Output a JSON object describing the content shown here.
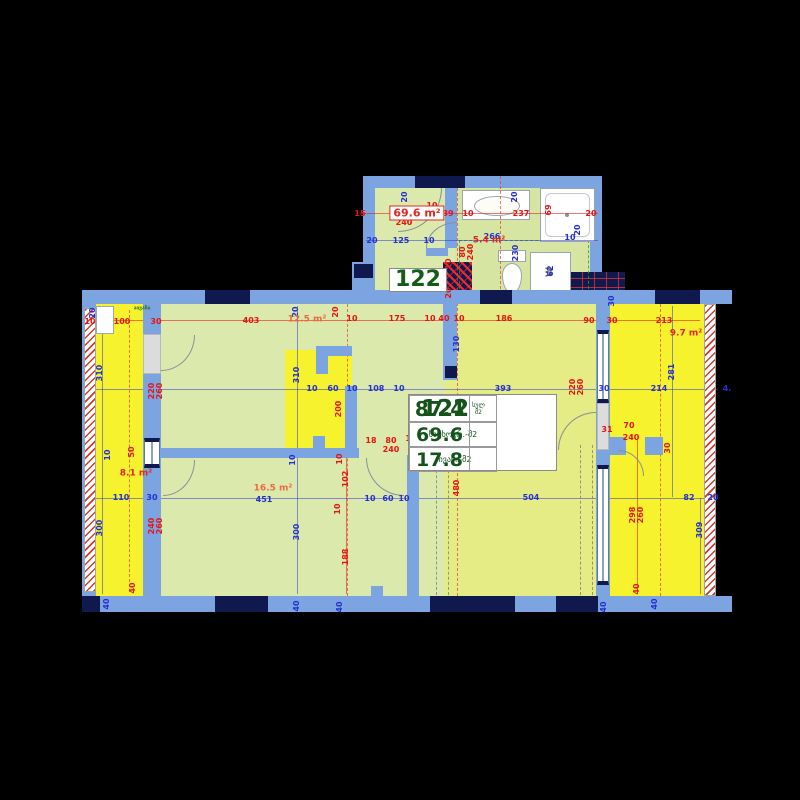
{
  "colors": {
    "background": "#000000",
    "wall_blue": "#7ba4e0",
    "column_navy": "#10194e",
    "room_green": "#dce9ad",
    "living_olive": "#e5eb85",
    "balcony_yellow": "#f6f22e",
    "bath_green": "#d6e5a2",
    "dim_red": "#e81313",
    "dim_blue": "#2430cf",
    "area_red": "#e3261d",
    "area_orange": "#ef6a3c",
    "label_green": "#155c15"
  },
  "info_card": {
    "unit_number": "122",
    "total_label_top": "სულ",
    "total_label_bottom": "მ2",
    "total_value": "87.4",
    "living_label": "საცხოვრ.-მ2",
    "living_value": "69.6",
    "balcony_label": "აივანი-მ2",
    "balcony_value": "17.8"
  },
  "fixtures": {
    "washer_label": "W"
  },
  "area_labels": [
    {
      "t": "69.6 m²",
      "x": 417,
      "y": 213,
      "s": "box-red"
    },
    {
      "t": "122",
      "x": 418,
      "y": 280,
      "s": "box-green"
    },
    {
      "t": "5.4 m²",
      "x": 489,
      "y": 241,
      "s": "red"
    },
    {
      "t": "12.5 m²",
      "x": 307,
      "y": 320,
      "s": "orange"
    },
    {
      "t": "8.1 m²",
      "x": 136,
      "y": 474,
      "s": "red"
    },
    {
      "t": "16.5 m²",
      "x": 273,
      "y": 489,
      "s": "orange"
    },
    {
      "t": "9.7 m²",
      "x": 686,
      "y": 334,
      "s": "red"
    },
    {
      "t": "აივანი",
      "x": 142,
      "y": 309,
      "s": "tiny-green"
    }
  ],
  "dims": [
    {
      "t": "15",
      "x": 360,
      "y": 214,
      "c": "r"
    },
    {
      "t": "95",
      "x": 396,
      "y": 214,
      "c": "r"
    },
    {
      "t": "15",
      "x": 417,
      "y": 214,
      "c": "r"
    },
    {
      "t": "10",
      "x": 432,
      "y": 206,
      "c": "r"
    },
    {
      "t": "39",
      "x": 448,
      "y": 214,
      "c": "r"
    },
    {
      "t": "240",
      "x": 404,
      "y": 223,
      "c": "r"
    },
    {
      "t": "10",
      "x": 468,
      "y": 214,
      "c": "r"
    },
    {
      "t": "237",
      "x": 521,
      "y": 214,
      "c": "r"
    },
    {
      "t": "20",
      "x": 591,
      "y": 214,
      "c": "r"
    },
    {
      "t": "69",
      "x": 549,
      "y": 210,
      "c": "r",
      "v": 1
    },
    {
      "t": "20",
      "x": 405,
      "y": 197,
      "c": "b",
      "v": 1
    },
    {
      "t": "20",
      "x": 515,
      "y": 197,
      "c": "b",
      "v": 1
    },
    {
      "t": "20",
      "x": 372,
      "y": 241,
      "c": "b"
    },
    {
      "t": "125",
      "x": 401,
      "y": 241,
      "c": "b"
    },
    {
      "t": "10",
      "x": 429,
      "y": 241,
      "c": "b"
    },
    {
      "t": "266",
      "x": 492,
      "y": 237,
      "c": "b"
    },
    {
      "t": "10",
      "x": 570,
      "y": 238,
      "c": "b"
    },
    {
      "t": "20",
      "x": 578,
      "y": 230,
      "c": "b",
      "v": 1
    },
    {
      "t": "230",
      "x": 516,
      "y": 253,
      "c": "b",
      "v": 1
    },
    {
      "t": "80",
      "x": 463,
      "y": 252,
      "c": "r",
      "v": 1
    },
    {
      "t": "240",
      "x": 471,
      "y": 252,
      "c": "r",
      "v": 1
    },
    {
      "t": "10",
      "x": 449,
      "y": 264,
      "c": "r",
      "v": 1
    },
    {
      "t": "20",
      "x": 449,
      "y": 293,
      "c": "r",
      "v": 1
    },
    {
      "t": "62",
      "x": 551,
      "y": 271,
      "c": "b",
      "v": 1
    },
    {
      "t": "10",
      "x": 90,
      "y": 322,
      "c": "r"
    },
    {
      "t": "100",
      "x": 122,
      "y": 322,
      "c": "r"
    },
    {
      "t": "30",
      "x": 156,
      "y": 322,
      "c": "r"
    },
    {
      "t": "403",
      "x": 251,
      "y": 321,
      "c": "r"
    },
    {
      "t": "20",
      "x": 93,
      "y": 313,
      "c": "b",
      "v": 1
    },
    {
      "t": "20",
      "x": 296,
      "y": 312,
      "c": "b",
      "v": 1
    },
    {
      "t": "20",
      "x": 336,
      "y": 312,
      "c": "r",
      "v": 1
    },
    {
      "t": "10",
      "x": 352,
      "y": 319,
      "c": "r"
    },
    {
      "t": "175",
      "x": 397,
      "y": 319,
      "c": "r"
    },
    {
      "t": "10",
      "x": 430,
      "y": 319,
      "c": "r"
    },
    {
      "t": "40",
      "x": 444,
      "y": 319,
      "c": "r"
    },
    {
      "t": "10",
      "x": 459,
      "y": 319,
      "c": "r"
    },
    {
      "t": "186",
      "x": 504,
      "y": 319,
      "c": "r"
    },
    {
      "t": "90",
      "x": 589,
      "y": 321,
      "c": "r"
    },
    {
      "t": "30",
      "x": 612,
      "y": 321,
      "c": "r"
    },
    {
      "t": "213",
      "x": 664,
      "y": 321,
      "c": "r"
    },
    {
      "t": "30",
      "x": 612,
      "y": 301,
      "c": "b",
      "v": 1
    },
    {
      "t": "130",
      "x": 457,
      "y": 344,
      "c": "b",
      "v": 1
    },
    {
      "t": "310",
      "x": 100,
      "y": 373,
      "c": "b",
      "v": 1
    },
    {
      "t": "310",
      "x": 297,
      "y": 375,
      "c": "b",
      "v": 1
    },
    {
      "t": "220",
      "x": 152,
      "y": 391,
      "c": "r",
      "v": 1
    },
    {
      "t": "260",
      "x": 160,
      "y": 391,
      "c": "r",
      "v": 1
    },
    {
      "t": "200",
      "x": 339,
      "y": 409,
      "c": "r",
      "v": 1
    },
    {
      "t": "10",
      "x": 312,
      "y": 389,
      "c": "b"
    },
    {
      "t": "60",
      "x": 333,
      "y": 389,
      "c": "b"
    },
    {
      "t": "10",
      "x": 352,
      "y": 389,
      "c": "b"
    },
    {
      "t": "108",
      "x": 376,
      "y": 389,
      "c": "b"
    },
    {
      "t": "10",
      "x": 399,
      "y": 389,
      "c": "b"
    },
    {
      "t": "393",
      "x": 503,
      "y": 389,
      "c": "b"
    },
    {
      "t": "220",
      "x": 573,
      "y": 387,
      "c": "r",
      "v": 1
    },
    {
      "t": "260",
      "x": 581,
      "y": 387,
      "c": "r",
      "v": 1
    },
    {
      "t": "30",
      "x": 604,
      "y": 389,
      "c": "b"
    },
    {
      "t": "214",
      "x": 659,
      "y": 389,
      "c": "b"
    },
    {
      "t": "4.",
      "x": 727,
      "y": 389,
      "c": "b"
    },
    {
      "t": "281",
      "x": 672,
      "y": 372,
      "c": "b",
      "v": 1
    },
    {
      "t": "50",
      "x": 132,
      "y": 452,
      "c": "r",
      "v": 1
    },
    {
      "t": "10",
      "x": 108,
      "y": 455,
      "c": "b",
      "v": 1
    },
    {
      "t": "18",
      "x": 371,
      "y": 441,
      "c": "r"
    },
    {
      "t": "80",
      "x": 391,
      "y": 441,
      "c": "r"
    },
    {
      "t": "240",
      "x": 391,
      "y": 450,
      "c": "r"
    },
    {
      "t": "10",
      "x": 411,
      "y": 439,
      "c": "r"
    },
    {
      "t": "10",
      "x": 340,
      "y": 459,
      "c": "r",
      "v": 1
    },
    {
      "t": "10",
      "x": 293,
      "y": 460,
      "c": "b",
      "v": 1
    },
    {
      "t": "31",
      "x": 607,
      "y": 430,
      "c": "r"
    },
    {
      "t": "70",
      "x": 629,
      "y": 426,
      "c": "r"
    },
    {
      "t": "240",
      "x": 631,
      "y": 438,
      "c": "r"
    },
    {
      "t": "30",
      "x": 668,
      "y": 448,
      "c": "r",
      "v": 1
    },
    {
      "t": "110",
      "x": 121,
      "y": 498,
      "c": "b"
    },
    {
      "t": "30",
      "x": 152,
      "y": 498,
      "c": "b"
    },
    {
      "t": "451",
      "x": 264,
      "y": 500,
      "c": "b"
    },
    {
      "t": "102",
      "x": 346,
      "y": 479,
      "c": "r",
      "v": 1
    },
    {
      "t": "10",
      "x": 338,
      "y": 509,
      "c": "r",
      "v": 1
    },
    {
      "t": "188",
      "x": 346,
      "y": 557,
      "c": "r",
      "v": 1
    },
    {
      "t": "10",
      "x": 370,
      "y": 499,
      "c": "b"
    },
    {
      "t": "60",
      "x": 388,
      "y": 499,
      "c": "b"
    },
    {
      "t": "10",
      "x": 404,
      "y": 499,
      "c": "b"
    },
    {
      "t": "480",
      "x": 457,
      "y": 488,
      "c": "r",
      "v": 1
    },
    {
      "t": "504",
      "x": 531,
      "y": 498,
      "c": "b"
    },
    {
      "t": "298",
      "x": 633,
      "y": 515,
      "c": "r",
      "v": 1
    },
    {
      "t": "260",
      "x": 641,
      "y": 515,
      "c": "r",
      "v": 1
    },
    {
      "t": "82",
      "x": 689,
      "y": 498,
      "c": "b"
    },
    {
      "t": "20",
      "x": 713,
      "y": 498,
      "c": "b"
    },
    {
      "t": "309",
      "x": 700,
      "y": 530,
      "c": "b",
      "v": 1
    },
    {
      "t": "240",
      "x": 152,
      "y": 526,
      "c": "r",
      "v": 1
    },
    {
      "t": "260",
      "x": 160,
      "y": 526,
      "c": "r",
      "v": 1
    },
    {
      "t": "300",
      "x": 100,
      "y": 528,
      "c": "b",
      "v": 1
    },
    {
      "t": "300",
      "x": 297,
      "y": 532,
      "c": "b",
      "v": 1
    },
    {
      "t": "40",
      "x": 133,
      "y": 588,
      "c": "r",
      "v": 1
    },
    {
      "t": "40",
      "x": 637,
      "y": 589,
      "c": "r",
      "v": 1
    },
    {
      "t": "40",
      "x": 107,
      "y": 604,
      "c": "b",
      "v": 1
    },
    {
      "t": "40",
      "x": 297,
      "y": 606,
      "c": "b",
      "v": 1
    },
    {
      "t": "40",
      "x": 340,
      "y": 607,
      "c": "b",
      "v": 1
    },
    {
      "t": "40",
      "x": 604,
      "y": 607,
      "c": "b",
      "v": 1
    },
    {
      "t": "40",
      "x": 655,
      "y": 604,
      "c": "b",
      "v": 1
    }
  ]
}
